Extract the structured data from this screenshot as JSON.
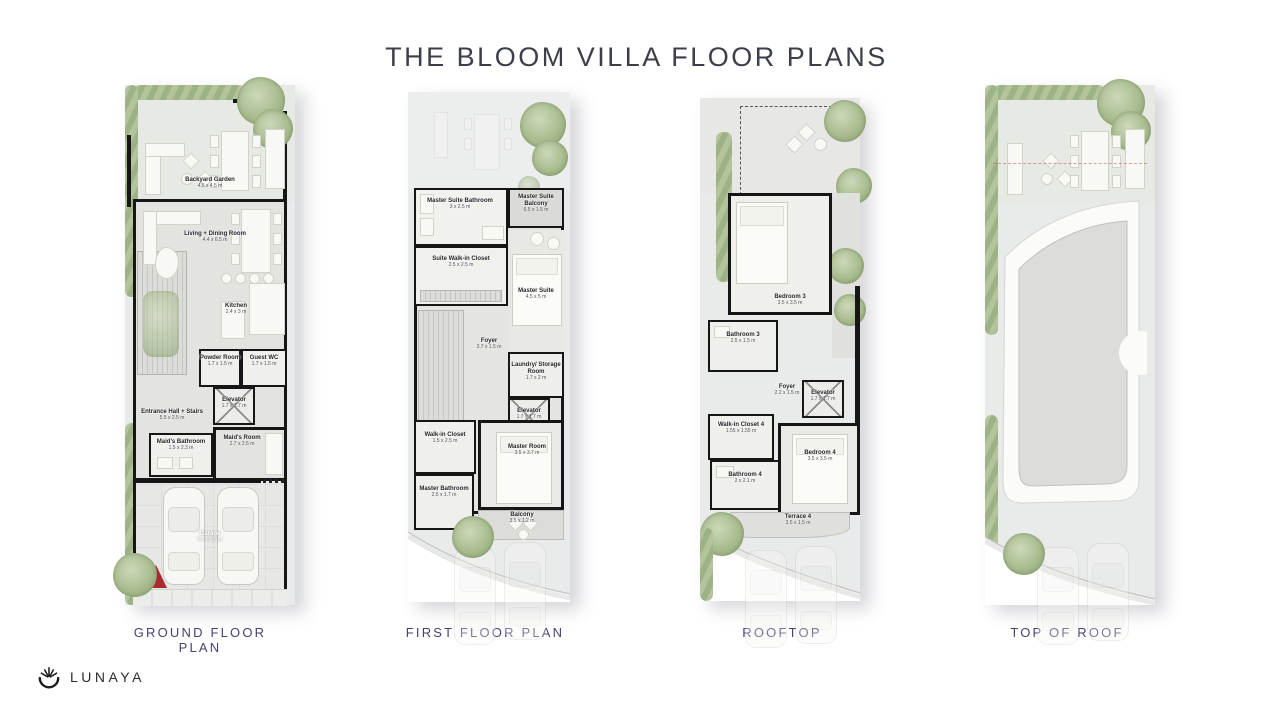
{
  "title": "THE BLOOM VILLA FLOOR PLANS",
  "brand": {
    "name": "LUNAYA"
  },
  "colors": {
    "title_text": "#3c3f49",
    "caption_text": "#4b3e73",
    "walls": "#161616",
    "foliage": "#a8bc8e",
    "marker_red": "#a8292e",
    "panel_bg": "#e9eaea"
  },
  "plans": [
    {
      "label": "GROUND FLOOR PLAN",
      "rooms": [
        {
          "name": "Backyard Garden",
          "dims": "4.5 x 4.5 m"
        },
        {
          "name": "Living + Dining Room",
          "dims": "4.4 x 6.5 m"
        },
        {
          "name": "Kitchen",
          "dims": "2.4 x 3 m"
        },
        {
          "name": "Powder Room",
          "dims": "1.7 x 1.5 m"
        },
        {
          "name": "Guest WC",
          "dims": "1.7 x 1.5 m"
        },
        {
          "name": "Elevator",
          "dims": "1.7 x 1.7 m"
        },
        {
          "name": "Entrance Hall + Stairs",
          "dims": "5.5 x 2.5 m"
        },
        {
          "name": "Maid's Bathroom",
          "dims": "1.5 x 2.3 m"
        },
        {
          "name": "Maid's Room",
          "dims": "2.7 x 2.5 m"
        },
        {
          "name": "Garage",
          "dims": "5.5 x 5.5 m"
        }
      ]
    },
    {
      "label": "FIRST FLOOR PLAN",
      "rooms": [
        {
          "name": "Master Suite Bathroom",
          "dims": "3 x 2.5 m"
        },
        {
          "name": "Master Suite Balcony",
          "dims": "6.5 x 1.5 m"
        },
        {
          "name": "Suite Walk-in Closet",
          "dims": "2.5 x 2.5 m"
        },
        {
          "name": "Master Suite",
          "dims": "4.5 x 5 m"
        },
        {
          "name": "Foyer",
          "dims": "3.7 x 1.5 m"
        },
        {
          "name": "Laundry/ Storage Room",
          "dims": "1.7 x 2 m"
        },
        {
          "name": "Elevator",
          "dims": "1.7 x 1.7 m"
        },
        {
          "name": "Walk-in Closet",
          "dims": "1.5 x 2.5 m"
        },
        {
          "name": "Master Room",
          "dims": "3.5 x 3.7 m"
        },
        {
          "name": "Master Bathroom",
          "dims": "2.5 x 1.7 m"
        },
        {
          "name": "Balcony",
          "dims": "3.5 x 1.2 m"
        }
      ]
    },
    {
      "label": "ROOFTOP",
      "rooms": [
        {
          "name": "Bedroom 3",
          "dims": "3.5 x 3.5 m"
        },
        {
          "name": "Bathroom 3",
          "dims": "2.5 x 1.5 m"
        },
        {
          "name": "Foyer",
          "dims": "2.2 x 1.5 m"
        },
        {
          "name": "Elevator",
          "dims": "1.7 x 1.7 m"
        },
        {
          "name": "Walk-in Closet 4",
          "dims": "1.55 x 1.55 m"
        },
        {
          "name": "Bathroom 4",
          "dims": "2 x 2.1 m"
        },
        {
          "name": "Bedroom 4",
          "dims": "3.5 x 3.5 m"
        },
        {
          "name": "Terrace 4",
          "dims": "3.5 x 1.5 m"
        }
      ]
    },
    {
      "label": "TOP OF ROOF",
      "rooms": []
    }
  ]
}
